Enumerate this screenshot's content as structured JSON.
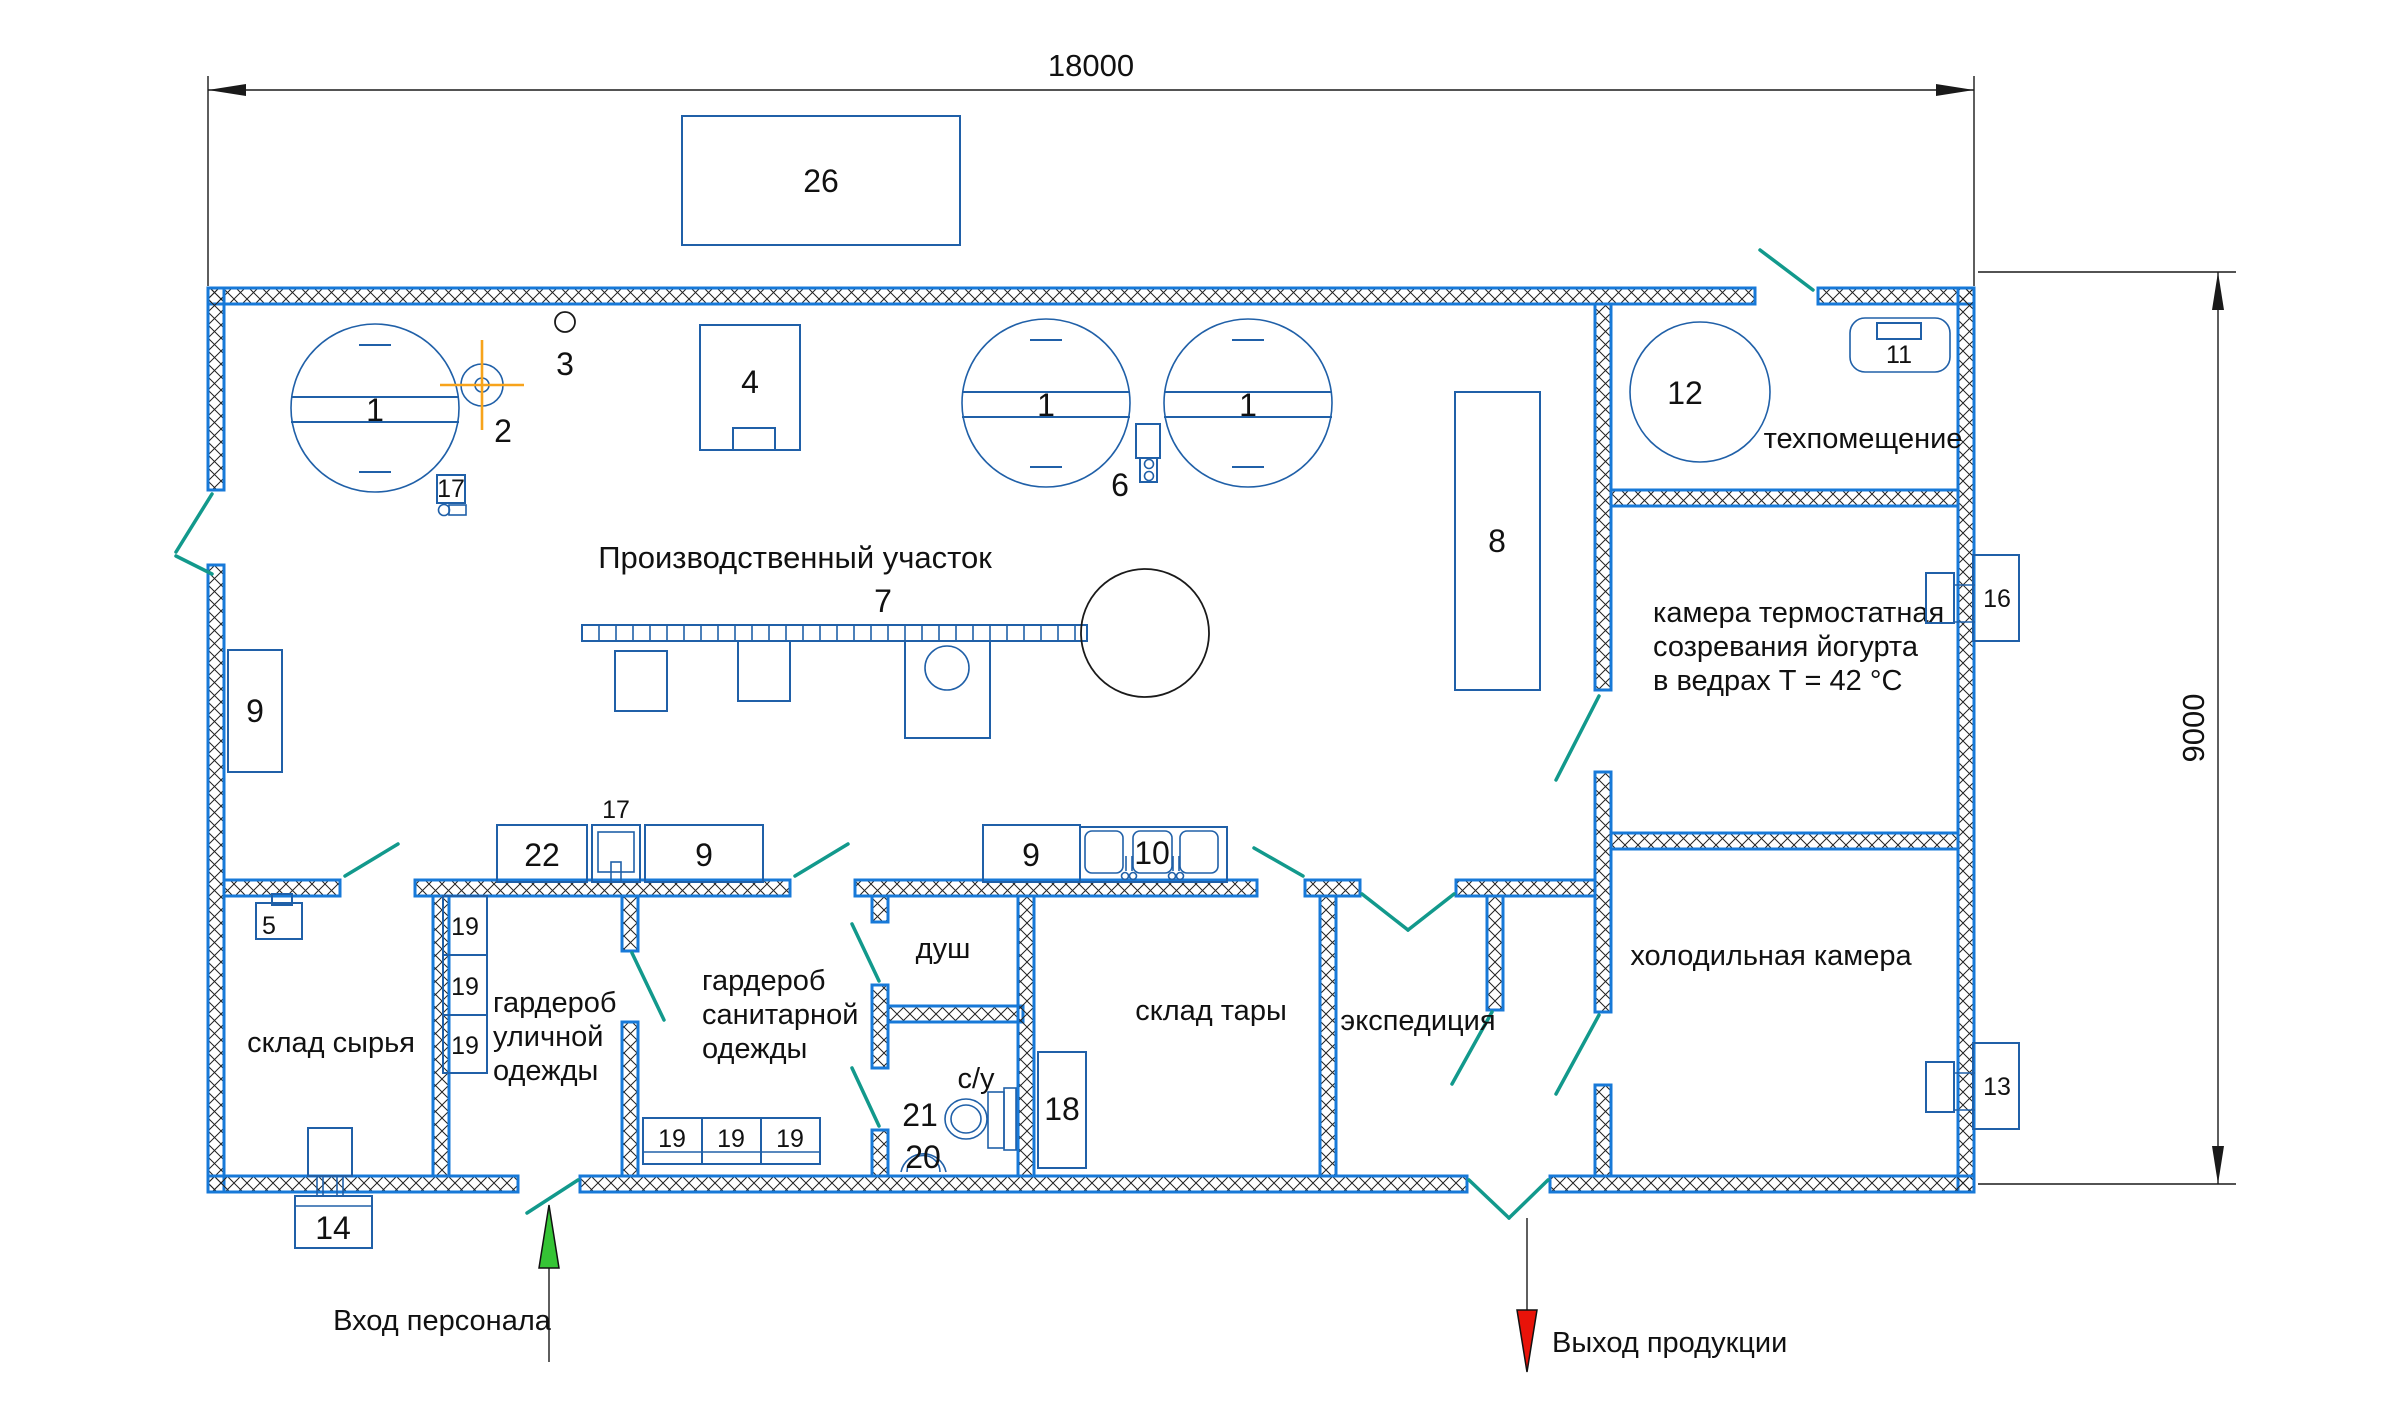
{
  "dims": {
    "width": "18000",
    "height": "9000"
  },
  "flows": {
    "entrance": "Вход персонала",
    "exit": "Выход продукции"
  },
  "rooms": {
    "production": "Производственный участок",
    "tech": "техпомещение",
    "thermo1": "камера термостатная",
    "thermo2": "созревания йогурта",
    "thermo3": "в ведрах Т = 42 °С",
    "cold": "холодильная камера",
    "raw": "склад сырья",
    "street1": "гардероб",
    "street2": "уличной",
    "street3": "одежды",
    "san1": "гардероб",
    "san2": "санитарной",
    "san3": "одежды",
    "shower": "душ",
    "wc": "с/у",
    "containers": "склад тары",
    "expedition": "экспедиция"
  },
  "eq": {
    "n1": "1",
    "n2": "2",
    "n3": "3",
    "n4": "4",
    "n5": "5",
    "n6": "6",
    "n7": "7",
    "n8": "8",
    "n9": "9",
    "n10": "10",
    "n11": "11",
    "n12": "12",
    "n13": "13",
    "n14": "14",
    "n16": "16",
    "n17": "17",
    "n18": "18",
    "n19": "19",
    "n20": "20",
    "n21": "21",
    "n22": "22",
    "n26": "26"
  },
  "colors": {
    "wall": "#1779d8",
    "equipment": "#2060a8",
    "door": "#12998c",
    "highlight": "#f7a31b",
    "entrance_arrow": "#35c435",
    "exit_arrow": "#e81309"
  }
}
